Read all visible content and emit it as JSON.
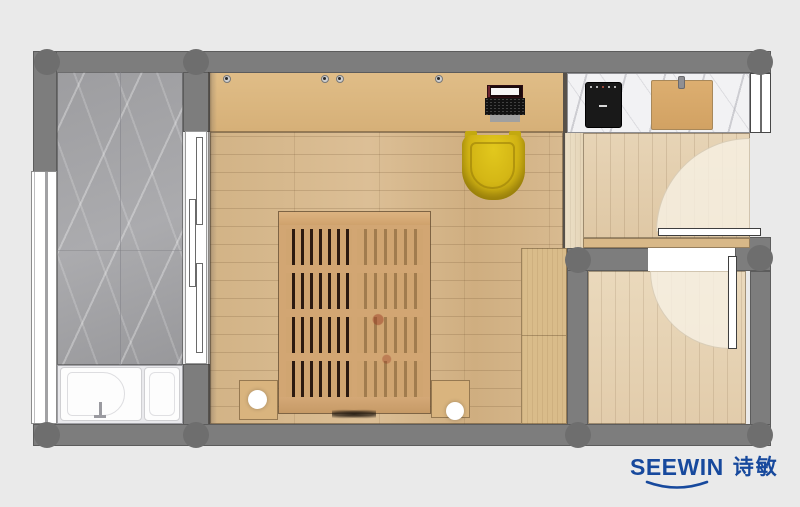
{
  "canvas": {
    "background": "#eaeaea"
  },
  "logo": {
    "brand": "SEEWIN",
    "cjk": "诗敏",
    "color": "#17499d"
  },
  "palette": {
    "wall_gray": "#7d7d7d",
    "column_gray": "#6e6e6e",
    "balcony_marble": "#a3a3a6",
    "counter_marble": "#f2f2f4",
    "bedroom_floor": "#d6b78c",
    "entry_floor": "#dfc8a5",
    "small_room_floor": "#e2ccab",
    "cabinet_wood": "#dcb77f",
    "bed_wood": "#d2a673",
    "chair_yellow": "#d2b414",
    "cooktop_black": "#191919",
    "fixture_white": "#ffffff",
    "accent_blue": "#17499d"
  },
  "furniture": [
    "wardrobe-cabinet",
    "desk",
    "laptop",
    "desk-chair",
    "double-bed",
    "nightstand-left",
    "nightstand-right",
    "bedside-lamp-left",
    "bedside-lamp-right",
    "side-wardrobe",
    "shower-tub",
    "bathtub",
    "kitchen-counter",
    "cooktop",
    "cutting-board",
    "sliding-door",
    "entry-door",
    "room-door",
    "window-left",
    "window-right"
  ]
}
